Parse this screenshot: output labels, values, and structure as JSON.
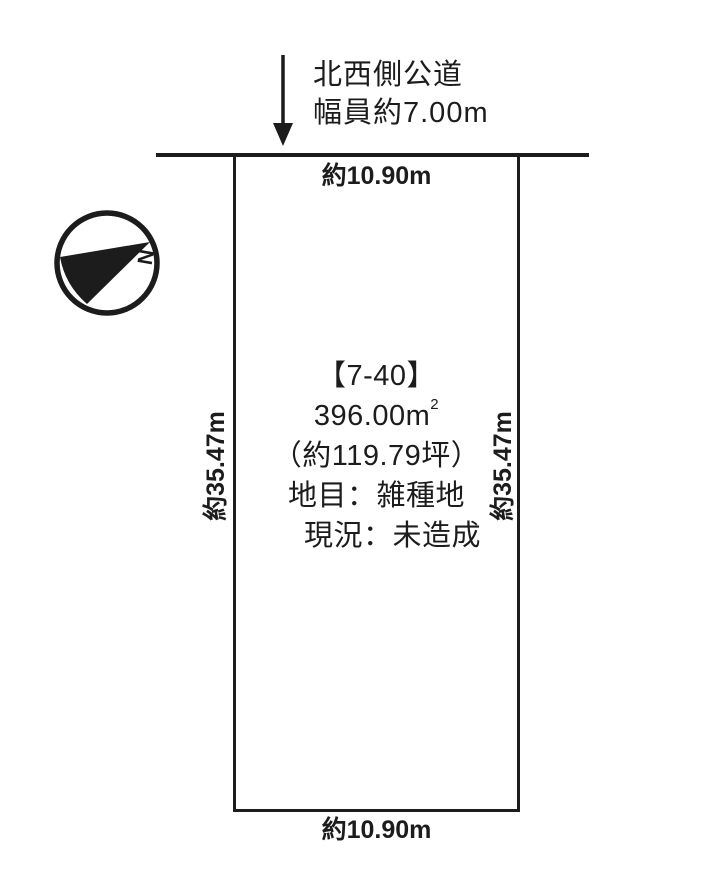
{
  "colors": {
    "ink": "#1c1c1c",
    "background": "#ffffff"
  },
  "road": {
    "name": "北西側公道",
    "width_label": "幅員約7.00m"
  },
  "compass": {
    "north_letter": "N"
  },
  "plot": {
    "number": "【7-40】",
    "area_m2_value": "396.00m",
    "area_m2_exponent": "2",
    "area_tsubo": "（約119.79坪）",
    "land_category_line": "地目：雑種地",
    "status_line": "現況：未造成",
    "frontage_top": "約10.90m",
    "frontage_bottom": "約10.90m",
    "depth_left": "約35.47m",
    "depth_right": "約35.47m"
  }
}
